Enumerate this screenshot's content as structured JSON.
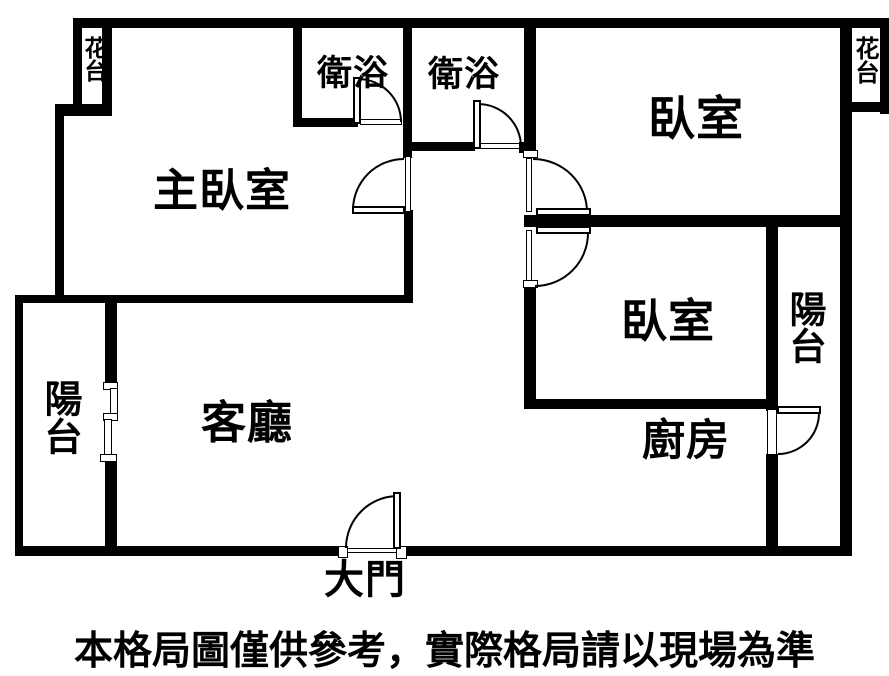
{
  "floor_plan": {
    "labels": {
      "flower_bed_left": "花台",
      "flower_bed_right": "花台",
      "master_bedroom": "主臥室",
      "bathroom_left": "衛浴",
      "bathroom_right": "衛浴",
      "bedroom_top_right": "臥室",
      "bedroom_right": "臥室",
      "balcony_left": "陽台",
      "balcony_right": "陽台",
      "living_room": "客廳",
      "kitchen": "廚房",
      "main_entrance": "大門"
    },
    "disclaimer": "本格局圖僅供參考，實際格局請以現場為準",
    "colors": {
      "wall": "#000000",
      "background": "#ffffff",
      "text": "#000000"
    }
  }
}
